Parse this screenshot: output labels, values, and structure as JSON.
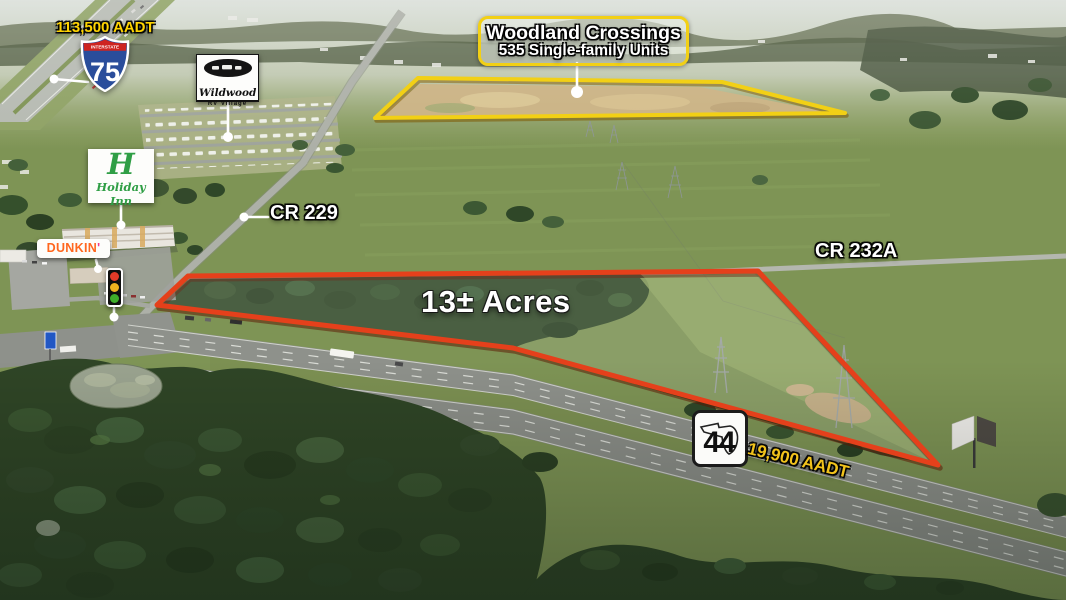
{
  "annotations": {
    "i75_aadt": {
      "text": "113,500 AADT",
      "color": "#ffd400"
    },
    "i75_shield": {
      "header": "INTERSTATE",
      "number": "75"
    },
    "wildwood_sign": {
      "name": "Wildwood",
      "subtitle": "RV Village"
    },
    "woodland_label": {
      "title": "Woodland Crossings",
      "subtitle": "535 Single-family Units",
      "outline_color": "#f2d015"
    },
    "holiday_inn_sign": {
      "monogram": "H",
      "name": "Holiday Inn",
      "brand_color": "#2f9e45"
    },
    "dunkin_sign": {
      "name": "DUNKIN",
      "apostrophe": "'",
      "brand_color": "#ff671f",
      "apostrophe_color": "#f0398e"
    },
    "traffic_signal": {
      "red": "#e23a28",
      "amber": "#f0b41f",
      "green": "#3fae2a"
    },
    "cr229_label": {
      "text": "CR 229"
    },
    "cr232a_label": {
      "text": "CR 232A"
    },
    "acres_label": {
      "text": "13± Acres"
    },
    "sr44_shield": {
      "number": "44"
    },
    "sr44_aadt": {
      "text": "19,900 AADT",
      "color": "#f2c31c"
    },
    "parcels": {
      "primary_outline_color": "#e5401b",
      "woodland_outline_color": "#f2d015"
    }
  }
}
